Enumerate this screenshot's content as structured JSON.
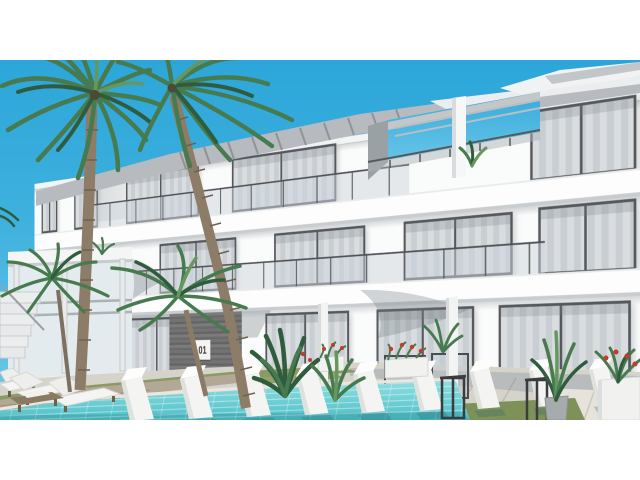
{
  "scene": {
    "title": "architectural-render-white-apartment-building-with-pool",
    "description": "3D exterior rendering of a modern white three-storey apartment building with rooftop pergola, curtain-glass windows, balconies, palm trees, swimming pool with rows of white sun loungers, wooden deck, potted plants and flower planters, on white page margins",
    "sign": {
      "unit_number": "01"
    },
    "colors": {
      "sky_top": "#2CA6D9",
      "sky_bottom": "#71CAE8",
      "facade_white": "#FAFBFB",
      "window_frame": "#55595D",
      "curtain_light": "#D9DDE0",
      "curtain_dark": "#C9CED2",
      "roof_gray": "#B7BBBF",
      "stone_dark": "#6A6A6A",
      "sign_bg": "#F4F4F2",
      "sign_text": "#3A3A3A",
      "palm_trunk": "#8D7C67",
      "palm_dark": "#2F5C3E",
      "palm_mid": "#477B4F",
      "palm_light": "#66975F",
      "pool_light": "#8FDEE0",
      "pool_deep": "#4FC0C9",
      "grass": "#8A9A64",
      "deck_wood": "#B3A795",
      "pavement": "#D6D3CB",
      "lounger_white": "#F4F5F3",
      "flower_red": "#C23B2E",
      "planter_white": "#F1F2F0",
      "lamp_dark": "#3A3C3E"
    },
    "objects": [
      "sky",
      "apartment-building",
      "rooftop-pergola",
      "rooftop-terrace",
      "curtain-windows",
      "glass-balustrade",
      "entrance-stone-wall",
      "unit-number-sign",
      "palm-trees",
      "swimming-pool",
      "pool-loungers",
      "deck-loungers",
      "wooden-deck",
      "grass",
      "pavement",
      "flower-planters",
      "potted-plants",
      "lantern-lamps",
      "pergola-left",
      "stairs"
    ]
  }
}
